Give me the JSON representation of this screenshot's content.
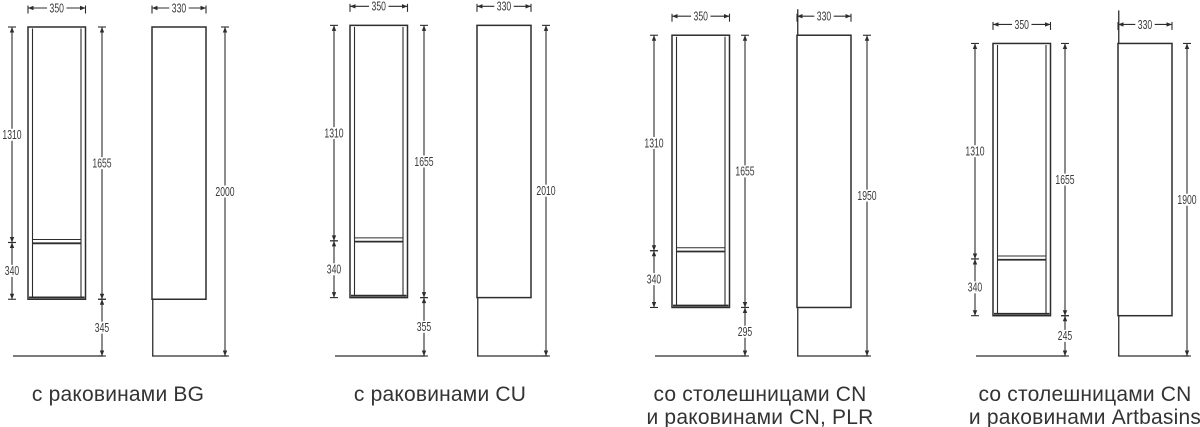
{
  "page": {
    "background": "#ffffff",
    "line_color": "#2d2d2d",
    "dim_text_color": "#3a3a3a",
    "label_text_color": "#333333"
  },
  "groups": [
    {
      "id": "bg",
      "label_lines": [
        "с раковинами BG",
        ""
      ],
      "front_view": {
        "width_mm": "350",
        "upper_section_mm": "1310",
        "lower_section_mm": "340",
        "cabinet_height_mm": "1655",
        "floor_gap_mm": "345"
      },
      "side_view": {
        "depth_mm": "330",
        "total_height_mm": "2000"
      }
    },
    {
      "id": "cu",
      "label_lines": [
        "с раковинами CU",
        ""
      ],
      "front_view": {
        "width_mm": "350",
        "upper_section_mm": "1310",
        "lower_section_mm": "340",
        "cabinet_height_mm": "1655",
        "floor_gap_mm": "355"
      },
      "side_view": {
        "depth_mm": "330",
        "total_height_mm": "2010"
      }
    },
    {
      "id": "cn-plr",
      "label_lines": [
        "со столешницами CN",
        "и раковинами CN, PLR"
      ],
      "front_view": {
        "width_mm": "350",
        "upper_section_mm": "1310",
        "lower_section_mm": "340",
        "cabinet_height_mm": "1655",
        "floor_gap_mm": "295"
      },
      "side_view": {
        "depth_mm": "330",
        "total_height_mm": "1950"
      }
    },
    {
      "id": "artbasins",
      "label_lines": [
        "со столешницами CN",
        "и раковинами Artbasins"
      ],
      "front_view": {
        "width_mm": "350",
        "upper_section_mm": "1310",
        "lower_section_mm": "340",
        "cabinet_height_mm": "1655",
        "floor_gap_mm": "245"
      },
      "side_view": {
        "depth_mm": "330",
        "total_height_mm": "1900"
      }
    }
  ]
}
